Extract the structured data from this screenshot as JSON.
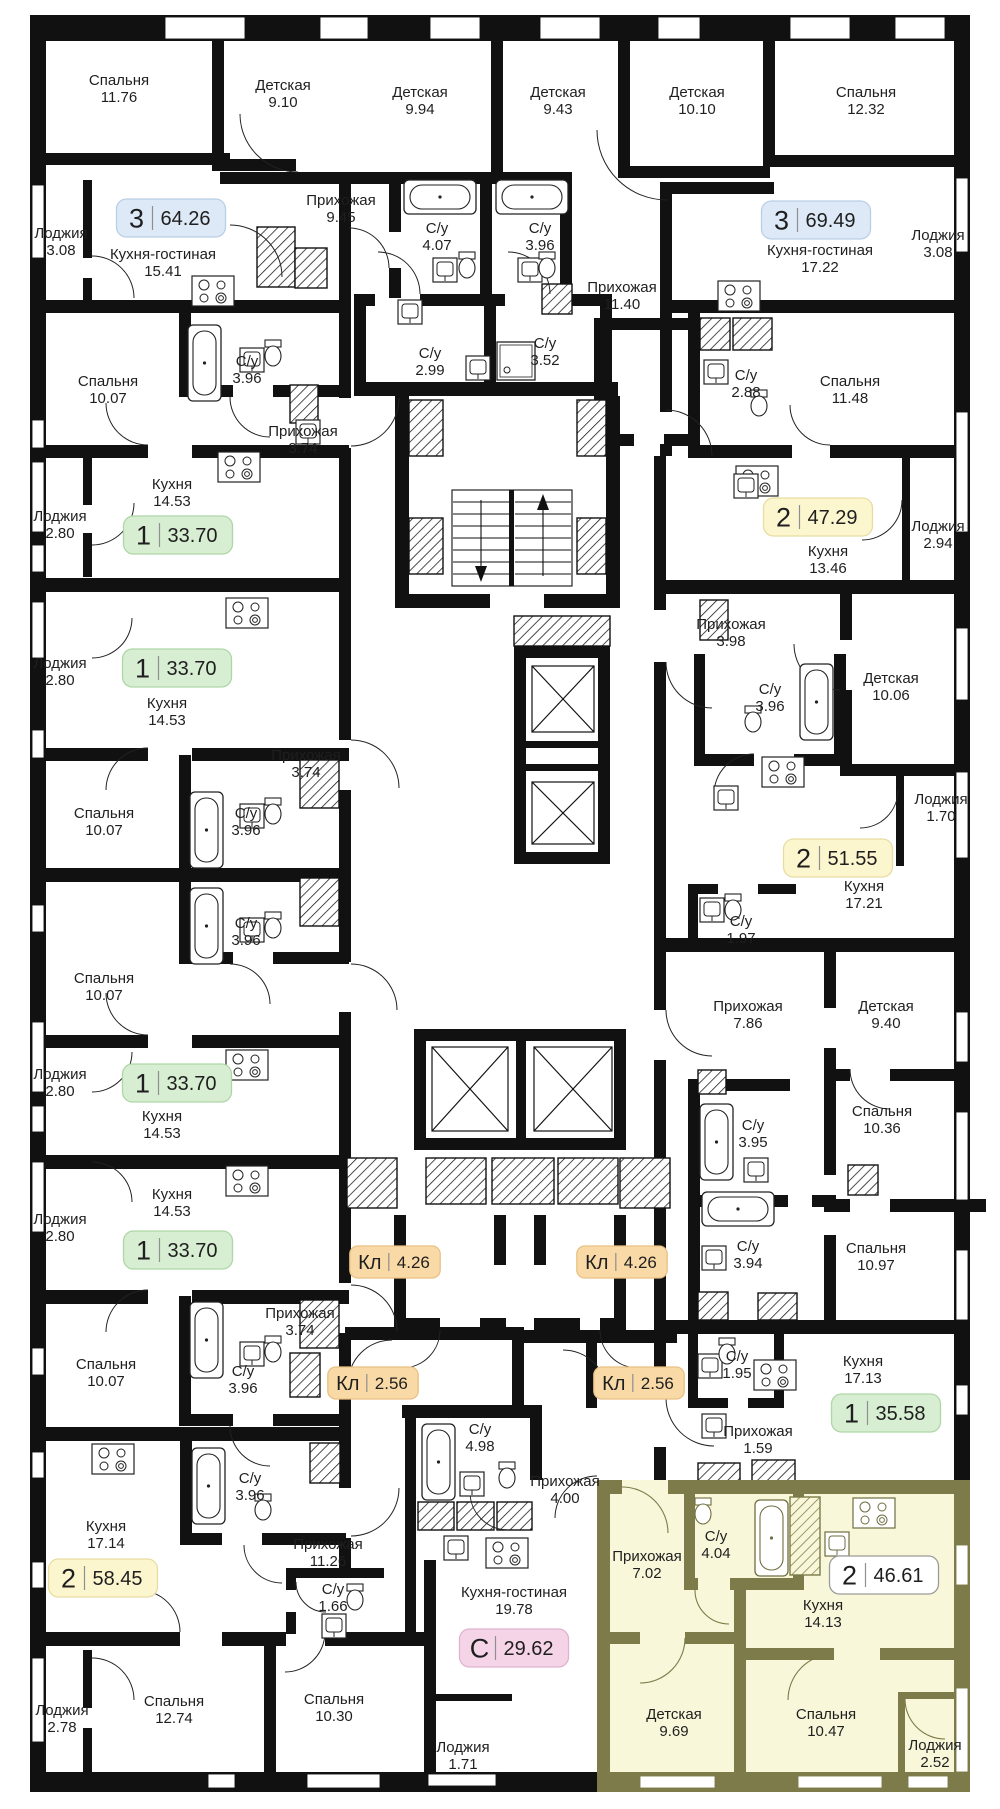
{
  "plan": {
    "colors": {
      "wall": "#111111",
      "background": "#ffffff",
      "highlight_fill": "#f9f7d9",
      "highlight_wall": "#7c7b49",
      "label_text": "#1f1f1f",
      "badge_divider": "#8f8f8f"
    },
    "badge_styles": {
      "blue": {
        "fill": "#dde9f7",
        "stroke": "#b9cfe4"
      },
      "green": {
        "fill": "#d7eed2",
        "stroke": "#aed6a6"
      },
      "yellow": {
        "fill": "#fcf6cf",
        "stroke": "#e8dca2"
      },
      "orange": {
        "fill": "#f9d9a6",
        "stroke": "#e9c183"
      },
      "pink": {
        "fill": "#f5d4e7",
        "stroke": "#e0b2cf"
      },
      "white": {
        "fill": "#ffffff",
        "stroke": "#9a9a9a"
      }
    },
    "badges": [
      {
        "kind": "3",
        "area": "64.26",
        "x": 171,
        "y": 218,
        "style": "blue"
      },
      {
        "kind": "3",
        "area": "69.49",
        "x": 816,
        "y": 220,
        "style": "blue"
      },
      {
        "kind": "1",
        "area": "33.70",
        "x": 178,
        "y": 535,
        "style": "green"
      },
      {
        "kind": "2",
        "area": "47.29",
        "x": 818,
        "y": 517,
        "style": "yellow"
      },
      {
        "kind": "1",
        "area": "33.70",
        "x": 177,
        "y": 668,
        "style": "green"
      },
      {
        "kind": "2",
        "area": "51.55",
        "x": 838,
        "y": 858,
        "style": "yellow"
      },
      {
        "kind": "1",
        "area": "33.70",
        "x": 177,
        "y": 1083,
        "style": "green"
      },
      {
        "kind": "1",
        "area": "33.70",
        "x": 178,
        "y": 1250,
        "style": "green"
      },
      {
        "kind": "Кл",
        "area": "4.26",
        "x": 395,
        "y": 1262,
        "style": "orange"
      },
      {
        "kind": "Кл",
        "area": "4.26",
        "x": 622,
        "y": 1262,
        "style": "orange"
      },
      {
        "kind": "Кл",
        "area": "2.56",
        "x": 373,
        "y": 1383,
        "style": "orange"
      },
      {
        "kind": "Кл",
        "area": "2.56",
        "x": 639,
        "y": 1383,
        "style": "orange"
      },
      {
        "kind": "2",
        "area": "58.45",
        "x": 103,
        "y": 1578,
        "style": "yellow"
      },
      {
        "kind": "1",
        "area": "35.58",
        "x": 886,
        "y": 1413,
        "style": "green"
      },
      {
        "kind": "С",
        "area": "29.62",
        "x": 514,
        "y": 1648,
        "style": "pink"
      },
      {
        "kind": "2",
        "area": "46.61",
        "x": 884,
        "y": 1575,
        "style": "white"
      }
    ],
    "rooms": [
      {
        "label": "Спальня",
        "area": "11.76",
        "x": 119,
        "y": 85
      },
      {
        "label": "Детская",
        "area": "9.10",
        "x": 283,
        "y": 90
      },
      {
        "label": "Детская",
        "area": "9.94",
        "x": 420,
        "y": 97
      },
      {
        "label": "Детская",
        "area": "9.43",
        "x": 558,
        "y": 97
      },
      {
        "label": "Детская",
        "area": "10.10",
        "x": 697,
        "y": 97
      },
      {
        "label": "Спальня",
        "area": "12.32",
        "x": 866,
        "y": 97
      },
      {
        "label": "Прихожая",
        "area": "9.45",
        "x": 341,
        "y": 205
      },
      {
        "label": "С/у",
        "area": "4.07",
        "x": 437,
        "y": 233
      },
      {
        "label": "С/у",
        "area": "3.96",
        "x": 540,
        "y": 233
      },
      {
        "label": "Лоджия",
        "area": "3.08",
        "x": 61,
        "y": 238
      },
      {
        "label": "Кухня-гостиная",
        "area": "15.41",
        "x": 163,
        "y": 259
      },
      {
        "label": "Кухня-гостиная",
        "area": "17.22",
        "x": 820,
        "y": 255
      },
      {
        "label": "Лоджия",
        "area": "3.08",
        "x": 938,
        "y": 240
      },
      {
        "label": "Прихожая",
        "area": "11.40",
        "x": 622,
        "y": 292
      },
      {
        "label": "С/у",
        "area": "2.99",
        "x": 430,
        "y": 358
      },
      {
        "label": "С/у",
        "area": "3.52",
        "x": 545,
        "y": 348
      },
      {
        "label": "С/у",
        "area": "2.88",
        "x": 746,
        "y": 380
      },
      {
        "label": "Спальня",
        "area": "11.48",
        "x": 850,
        "y": 386
      },
      {
        "label": "Спальня",
        "area": "10.07",
        "x": 108,
        "y": 386
      },
      {
        "label": "С/у",
        "area": "3.96",
        "x": 247,
        "y": 366
      },
      {
        "label": "Прихожая",
        "area": "3.74",
        "x": 303,
        "y": 436
      },
      {
        "label": "Лоджия",
        "area": "2.80",
        "x": 60,
        "y": 521
      },
      {
        "label": "Кухня",
        "area": "14.53",
        "x": 172,
        "y": 489
      },
      {
        "label": "Кухня",
        "area": "13.46",
        "x": 828,
        "y": 556
      },
      {
        "label": "Лоджия",
        "area": "2.94",
        "x": 938,
        "y": 531
      },
      {
        "label": "Лоджия",
        "area": "2.80",
        "x": 60,
        "y": 668
      },
      {
        "label": "Кухня",
        "area": "14.53",
        "x": 167,
        "y": 708
      },
      {
        "label": "Прихожая",
        "area": "3.98",
        "x": 731,
        "y": 629
      },
      {
        "label": "С/у",
        "area": "3.96",
        "x": 770,
        "y": 694
      },
      {
        "label": "Детская",
        "area": "10.06",
        "x": 891,
        "y": 683
      },
      {
        "label": "Спальня",
        "area": "10.07",
        "x": 104,
        "y": 818
      },
      {
        "label": "С/у",
        "area": "3.96",
        "x": 246,
        "y": 818
      },
      {
        "label": "Прихожая",
        "area": "3.74",
        "x": 306,
        "y": 760
      },
      {
        "label": "Лоджия",
        "area": "1.70",
        "x": 941,
        "y": 804
      },
      {
        "label": "Кухня",
        "area": "17.21",
        "x": 864,
        "y": 891
      },
      {
        "label": "С/у",
        "area": "1.97",
        "x": 741,
        "y": 926
      },
      {
        "label": "Спальня",
        "area": "10.07",
        "x": 104,
        "y": 983
      },
      {
        "label": "С/у",
        "area": "3.96",
        "x": 246,
        "y": 928
      },
      {
        "label": "Прихожая",
        "area": "7.86",
        "x": 748,
        "y": 1011
      },
      {
        "label": "Детская",
        "area": "9.40",
        "x": 886,
        "y": 1011
      },
      {
        "label": "Лоджия",
        "area": "2.80",
        "x": 60,
        "y": 1079
      },
      {
        "label": "Кухня",
        "area": "14.53",
        "x": 162,
        "y": 1121
      },
      {
        "label": "Спальня",
        "area": "10.36",
        "x": 882,
        "y": 1116
      },
      {
        "label": "С/у",
        "area": "3.95",
        "x": 753,
        "y": 1130
      },
      {
        "label": "Лоджия",
        "area": "2.80",
        "x": 60,
        "y": 1224
      },
      {
        "label": "Кухня",
        "area": "14.53",
        "x": 172,
        "y": 1199
      },
      {
        "label": "С/у",
        "area": "3.94",
        "x": 748,
        "y": 1251
      },
      {
        "label": "Спальня",
        "area": "10.97",
        "x": 876,
        "y": 1253
      },
      {
        "label": "Прихожая",
        "area": "3.74",
        "x": 300,
        "y": 1318
      },
      {
        "label": "Спальня",
        "area": "10.07",
        "x": 106,
        "y": 1369
      },
      {
        "label": "С/у",
        "area": "3.96",
        "x": 243,
        "y": 1376
      },
      {
        "label": "С/у",
        "area": "3.96",
        "x": 250,
        "y": 1483
      },
      {
        "label": "С/у",
        "area": "4.98",
        "x": 480,
        "y": 1434
      },
      {
        "label": "Кухня",
        "area": "17.14",
        "x": 106,
        "y": 1531
      },
      {
        "label": "Прихожая",
        "area": "11.26",
        "x": 328,
        "y": 1549
      },
      {
        "label": "С/у",
        "area": "1.95",
        "x": 737,
        "y": 1361
      },
      {
        "label": "Кухня",
        "area": "17.13",
        "x": 863,
        "y": 1366
      },
      {
        "label": "Прихожая",
        "area": "1.59",
        "x": 758,
        "y": 1436
      },
      {
        "label": "Прихожая",
        "area": "4.00",
        "x": 565,
        "y": 1486
      },
      {
        "label": "С/у",
        "area": "1.66",
        "x": 333,
        "y": 1594
      },
      {
        "label": "Кухня-гостиная",
        "area": "19.78",
        "x": 514,
        "y": 1597
      },
      {
        "label": "Прихожая",
        "area": "7.02",
        "x": 647,
        "y": 1561
      },
      {
        "label": "С/у",
        "area": "4.04",
        "x": 716,
        "y": 1541
      },
      {
        "label": "Кухня",
        "area": "14.13",
        "x": 823,
        "y": 1610
      },
      {
        "label": "Спальня",
        "area": "12.74",
        "x": 174,
        "y": 1706
      },
      {
        "label": "Спальня",
        "area": "10.30",
        "x": 334,
        "y": 1704
      },
      {
        "label": "Лоджия",
        "area": "2.78",
        "x": 62,
        "y": 1715
      },
      {
        "label": "Лоджия",
        "area": "1.71",
        "x": 463,
        "y": 1752
      },
      {
        "label": "Детская",
        "area": "9.69",
        "x": 674,
        "y": 1719
      },
      {
        "label": "Спальня",
        "area": "10.47",
        "x": 826,
        "y": 1719
      },
      {
        "label": "Лоджия",
        "area": "2.52",
        "x": 935,
        "y": 1750
      }
    ]
  }
}
